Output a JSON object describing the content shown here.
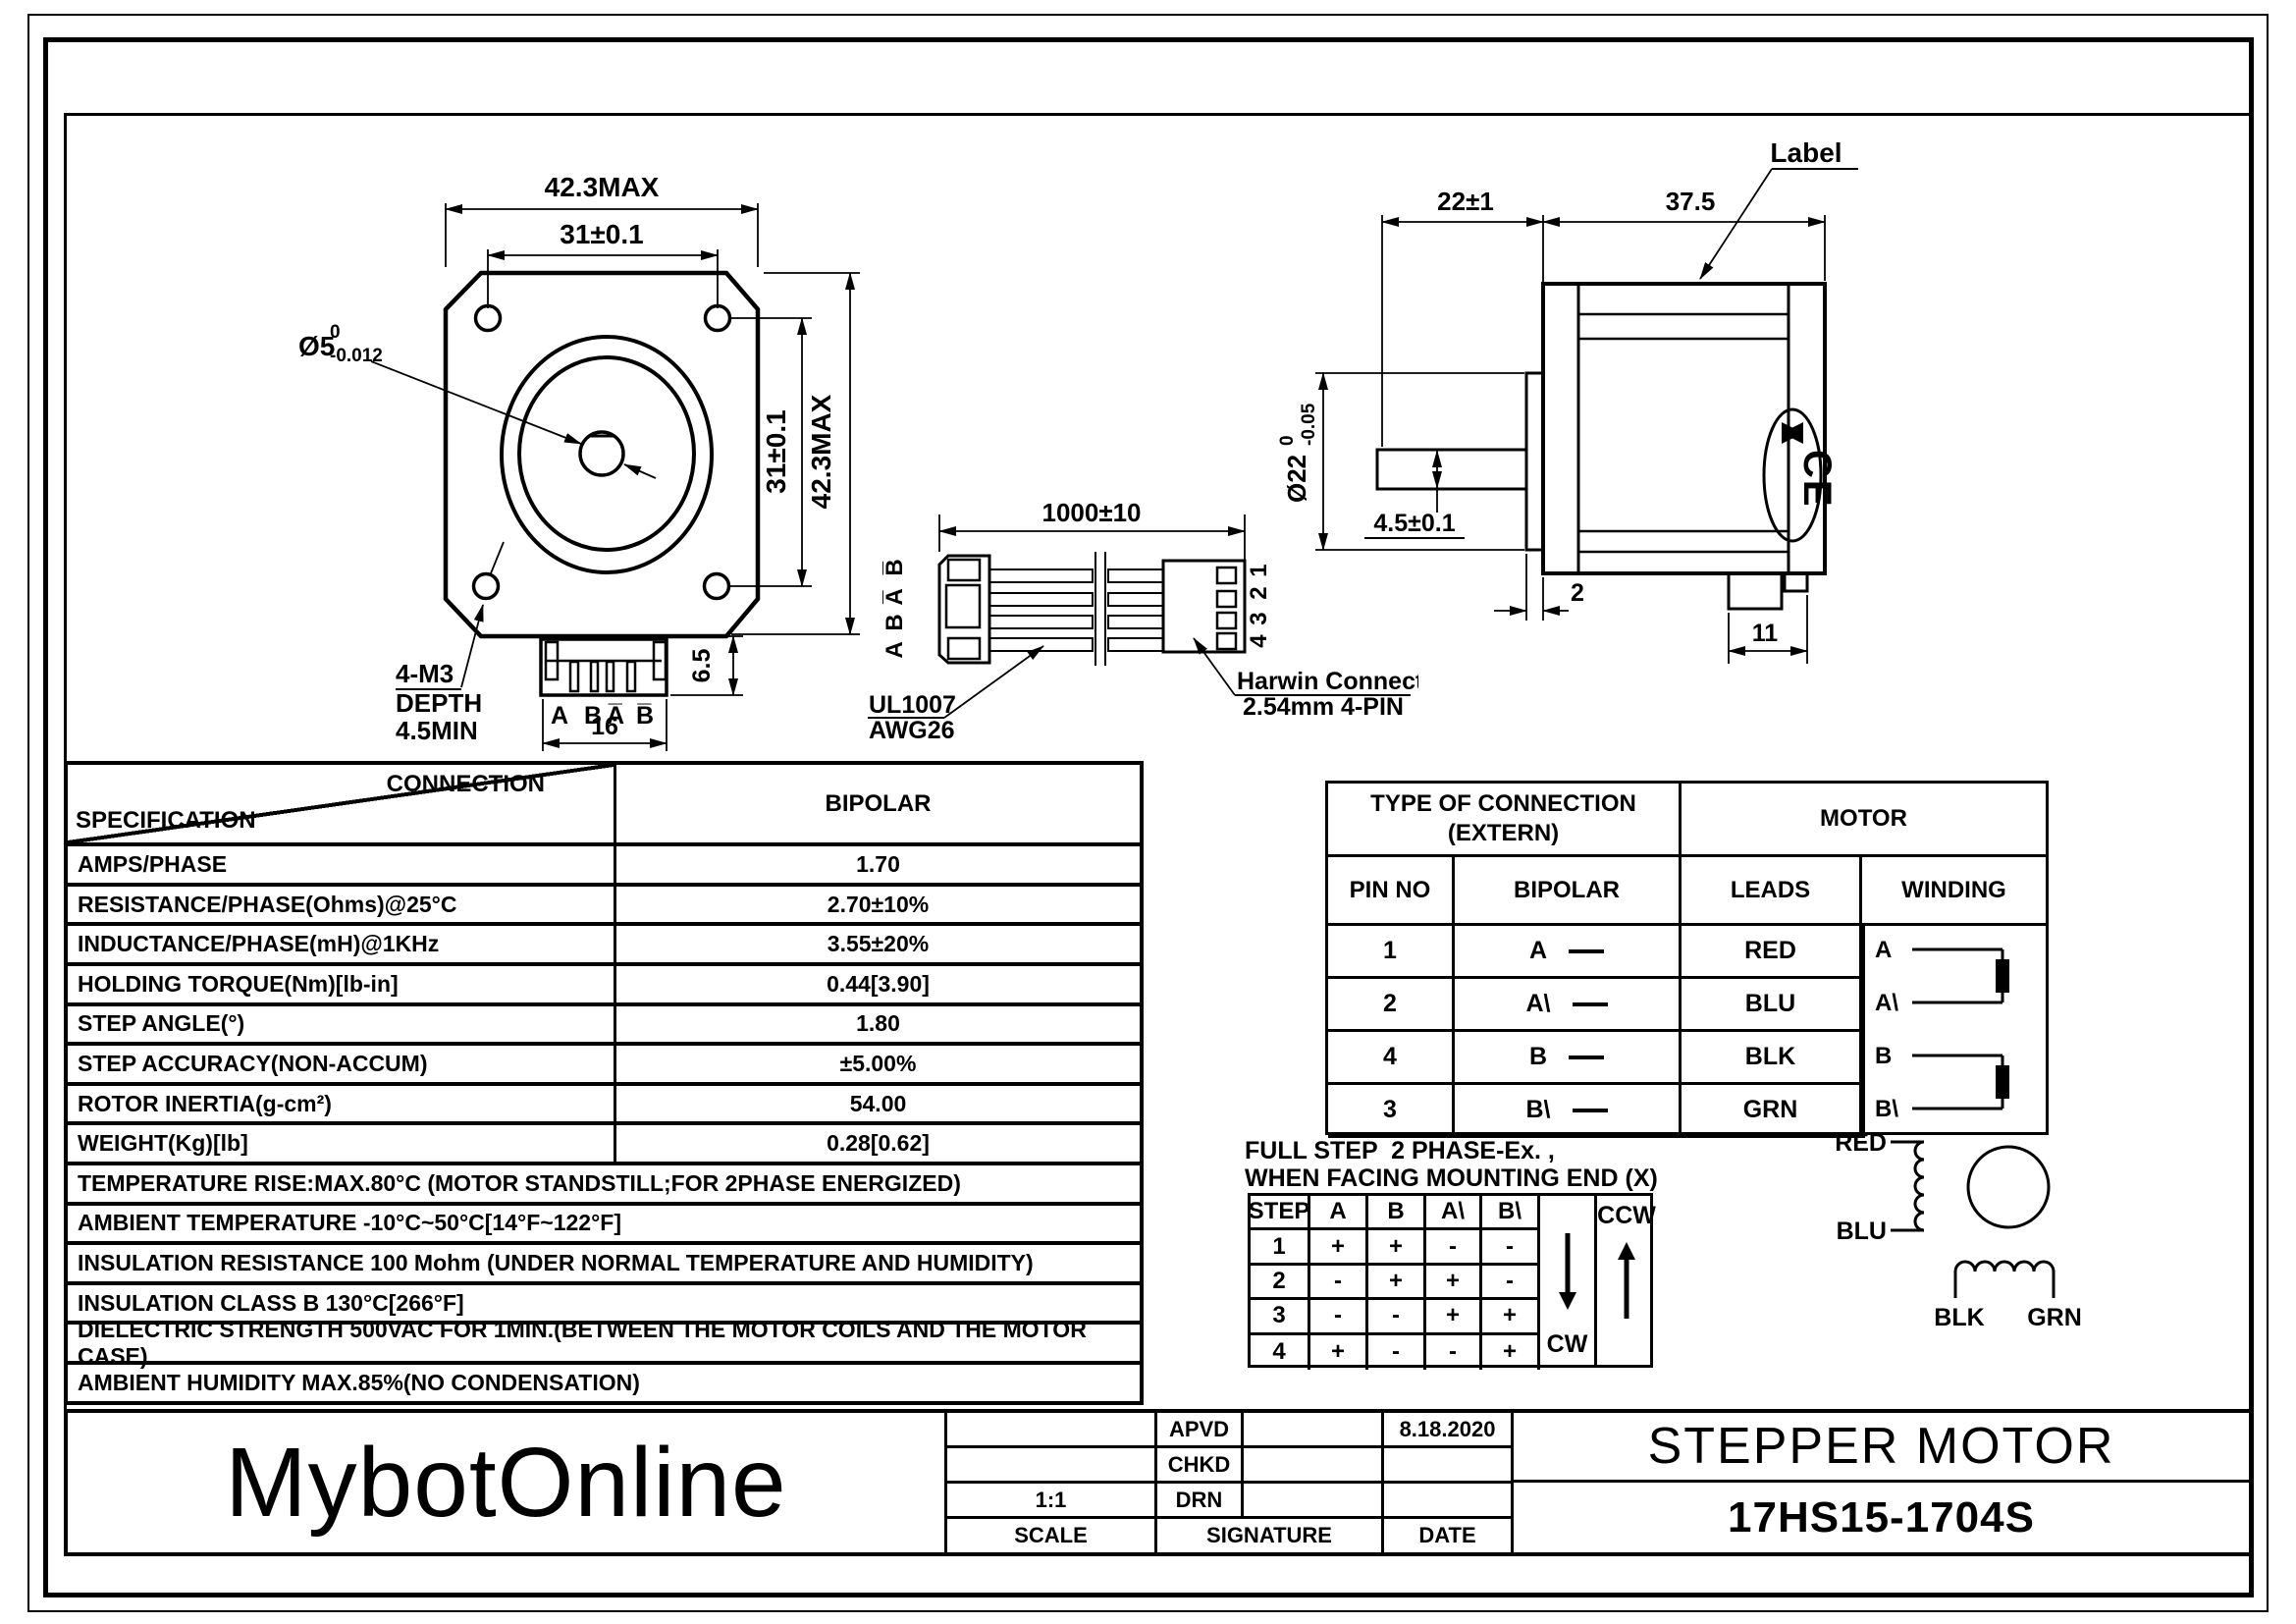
{
  "front_view": {
    "dim_width": "42.3MAX",
    "dim_hole_h": "31±0.1",
    "shaft_label": "Ø5",
    "shaft_tol_top": "0",
    "shaft_tol_bot": "-0.012",
    "dim_hole_v": "31±0.1",
    "dim_height": "42.3MAX",
    "thread_note1": "4-M3",
    "thread_note2": "DEPTH",
    "thread_note3": "4.5MIN",
    "pin_a": "A",
    "pin_b": "B",
    "pin_abar": "A̅",
    "pin_bbar": "B̅",
    "dim_conn_w": "16",
    "dim_conn_h": "6.5"
  },
  "cable": {
    "dim_length": "1000±10",
    "labels_left": [
      "B̅",
      "A̅",
      "B",
      "A"
    ],
    "pins_right": [
      "1",
      "2",
      "3",
      "4"
    ],
    "wire_note1": "UL1007",
    "wire_note2": "AWG26",
    "conn_note1": "Harwin Connector",
    "conn_note2": "2.54mm 4-PIN"
  },
  "side_view": {
    "dim_shaft_len": "22±1",
    "dim_body_len": "37.5",
    "label_note": "Label",
    "boss_dia": "Ø22",
    "boss_tol_top": "0",
    "boss_tol_bot": "-0.05",
    "dim_shaft_dia": "4.5±0.1",
    "dim_boss_t": "2",
    "dim_conn_w": "11",
    "ce_text": "CE"
  },
  "spec_table": {
    "corner_top": "CONNECTION",
    "corner_bottom": "SPECIFICATION",
    "col_value": "BIPOLAR",
    "rows": [
      {
        "label": "AMPS/PHASE",
        "value": "1.70"
      },
      {
        "label": "RESISTANCE/PHASE(Ohms)@25°C",
        "value": "2.70±10%"
      },
      {
        "label": "INDUCTANCE/PHASE(mH)@1KHz",
        "value": "3.55±20%"
      },
      {
        "label": "HOLDING TORQUE(Nm)[lb-in]",
        "value": "0.44[3.90]"
      },
      {
        "label": "STEP ANGLE(°)",
        "value": "1.80"
      },
      {
        "label": "STEP ACCURACY(NON-ACCUM)",
        "value": "±5.00%"
      },
      {
        "label": "ROTOR INERTIA(g-cm²)",
        "value": "54.00"
      },
      {
        "label": "WEIGHT(Kg)[lb]",
        "value": "0.28[0.62]"
      }
    ],
    "notes": [
      "TEMPERATURE RISE:MAX.80°C (MOTOR STANDSTILL;FOR 2PHASE ENERGIZED)",
      "AMBIENT TEMPERATURE -10°C~50°C[14°F~122°F]",
      "INSULATION RESISTANCE 100 Mohm (UNDER NORMAL TEMPERATURE AND HUMIDITY)",
      "INSULATION CLASS B 130°C[266°F]",
      "DIELECTRIC STRENGTH 500VAC FOR 1MIN.(BETWEEN THE MOTOR COILS AND THE MOTOR CASE)",
      "AMBIENT HUMIDITY MAX.85%(NO CONDENSATION)"
    ]
  },
  "conn_table": {
    "header_extern_1": "TYPE OF CONNECTION",
    "header_extern_2": "(EXTERN)",
    "header_motor": "MOTOR",
    "col_pin": "PIN NO",
    "col_bipolar": "BIPOLAR",
    "col_leads": "LEADS",
    "col_winding": "WINDING",
    "rows": [
      {
        "pin": "1",
        "phase": "A",
        "lead": "RED"
      },
      {
        "pin": "2",
        "phase": "A\\",
        "lead": "BLU"
      },
      {
        "pin": "4",
        "phase": "B",
        "lead": "BLK"
      },
      {
        "pin": "3",
        "phase": "B\\",
        "lead": "GRN"
      }
    ],
    "winding_labels": {
      "a": "A",
      "abar": "A\\",
      "b": "B",
      "bbar": "B\\"
    }
  },
  "fullstep": {
    "title1": "FULL STEP  2 PHASE-Ex. ,",
    "title2": "WHEN FACING MOUNTING END (X)",
    "cols": [
      "STEP",
      "A",
      "B",
      "A\\",
      "B\\"
    ],
    "rows": [
      {
        "step": "1",
        "v": [
          "+",
          "+",
          "-",
          "-"
        ]
      },
      {
        "step": "2",
        "v": [
          "-",
          "+",
          "+",
          "-"
        ]
      },
      {
        "step": "3",
        "v": [
          "-",
          "-",
          "+",
          "+"
        ]
      },
      {
        "step": "4",
        "v": [
          "+",
          "-",
          "-",
          "+"
        ]
      }
    ],
    "cw": "CW",
    "ccw": "CCW"
  },
  "winding_diag": {
    "a_top": "RED",
    "a_bottom": "BLU",
    "b_left": "BLK",
    "b_right": "GRN"
  },
  "title_block": {
    "logo": "MybotOnline",
    "scale_value": "1:1",
    "scale_label": "SCALE",
    "row1_label": "APVD",
    "row1_date": "8.18.2020",
    "row2_label": "CHKD",
    "row3_label": "DRN",
    "signature_label": "SIGNATURE",
    "date_label": "DATE",
    "title": "STEPPER MOTOR",
    "part": "17HS15-1704S"
  }
}
